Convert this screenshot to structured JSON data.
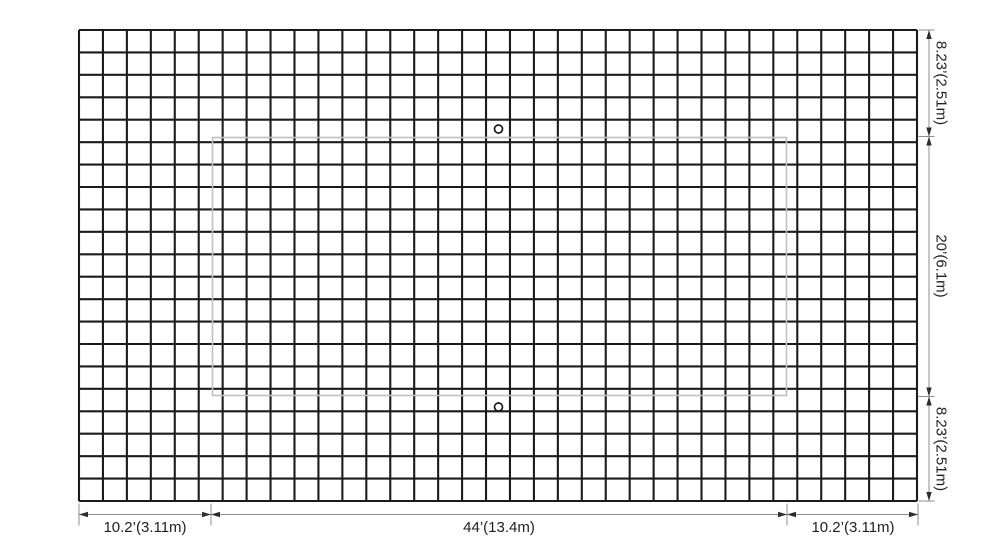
{
  "diagram": {
    "grid": {
      "columns": 35,
      "rows": 21
    },
    "right_dimensions": [
      {
        "label": "8.23’(2.51m)"
      },
      {
        "label": "20’(6.1m)"
      },
      {
        "label": "8.23’(2.51m)"
      }
    ],
    "bottom_dimensions": [
      {
        "label": "10.2’(3.11m)"
      },
      {
        "label": "44’(13.4m)"
      },
      {
        "label": "10.2’(3.11m)"
      }
    ],
    "grommet_count": 2,
    "colors": {
      "net": "#1b1b1b",
      "panel_outline": "#c0c0c0",
      "dimension_line": "#8e8e8e",
      "arrow": "#2e2e2e",
      "text": "#222222",
      "background": "#ffffff"
    }
  }
}
